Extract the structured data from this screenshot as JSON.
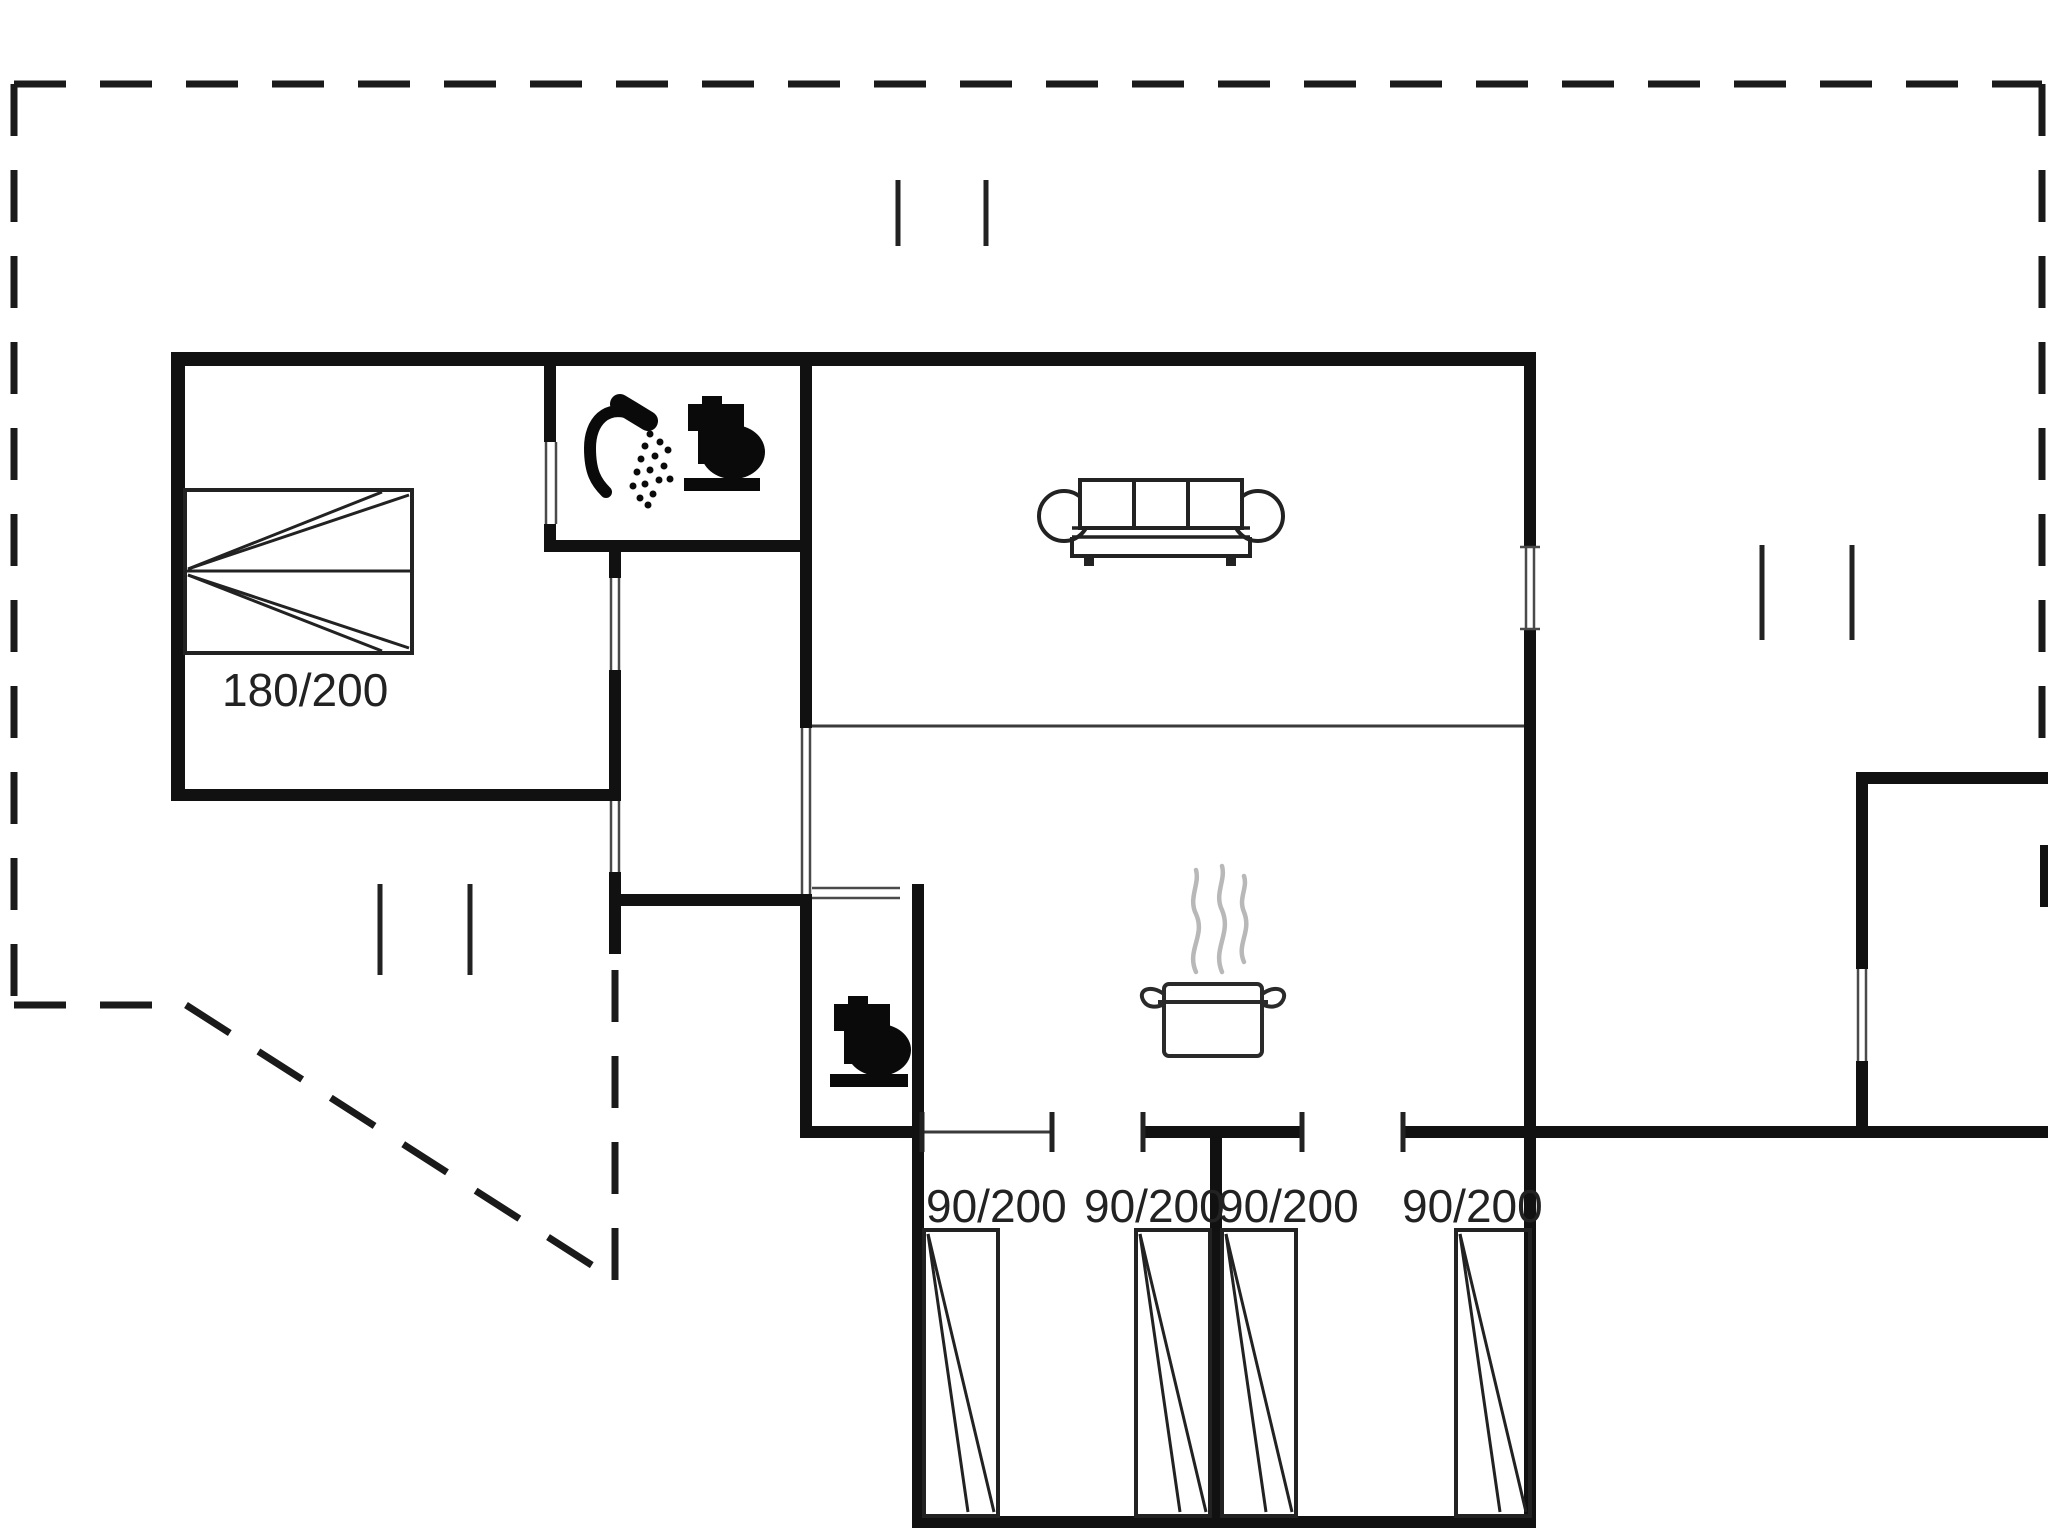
{
  "canvas": {
    "width": 2048,
    "height": 1536,
    "background": "#ffffff"
  },
  "colors": {
    "wall": "#111111",
    "thin_line": "#3a3a3a",
    "opening_line": "#4a4a4a",
    "dash": "#1a1a1a",
    "tick": "#222222",
    "furniture_stroke": "#222222",
    "icon_fill": "#0a0a0a",
    "steam": "#b8b8b8",
    "text": "#222222"
  },
  "labels": {
    "double_bed": "180/200",
    "single_bed": "90/200"
  },
  "floorplan": {
    "dashed_lines": [
      {
        "name": "boundary-top",
        "x1": 14,
        "y1": 84,
        "x2": 2042,
        "y2": 84
      },
      {
        "name": "boundary-left",
        "x1": 14,
        "y1": 84,
        "x2": 14,
        "y2": 1005
      },
      {
        "name": "boundary-bottom-left",
        "x1": 14,
        "y1": 1005,
        "x2": 186,
        "y2": 1005
      },
      {
        "name": "boundary-diagonal",
        "x1": 186,
        "y1": 1005,
        "x2": 615,
        "y2": 1280
      },
      {
        "name": "boundary-vertical-mid",
        "x1": 615,
        "y1": 1280,
        "x2": 615,
        "y2": 954
      },
      {
        "name": "boundary-right",
        "x1": 2042,
        "y1": 84,
        "x2": 2042,
        "y2": 772
      }
    ],
    "walls": [
      {
        "name": "wall-top",
        "x": 171,
        "y": 352,
        "w": 1365,
        "h": 14
      },
      {
        "name": "wall-left",
        "x": 171,
        "y": 352,
        "w": 14,
        "h": 449
      },
      {
        "name": "wall-bedroom-bottom",
        "x": 171,
        "y": 789,
        "w": 450,
        "h": 12
      },
      {
        "name": "wall-stub-under-bath",
        "x": 609,
        "y": 546,
        "w": 12,
        "h": 32
      },
      {
        "name": "wall-bedroom-hall",
        "x": 609,
        "y": 670,
        "w": 12,
        "h": 131
      },
      {
        "name": "wall-stub-below-bedroom",
        "x": 609,
        "y": 872,
        "w": 12,
        "h": 82
      },
      {
        "name": "wall-hall-bottom",
        "x": 609,
        "y": 894,
        "w": 203,
        "h": 12
      },
      {
        "name": "wall-bath-left-upper",
        "x": 544,
        "y": 366,
        "w": 12,
        "h": 76
      },
      {
        "name": "wall-bath-left-lower",
        "x": 544,
        "y": 524,
        "w": 12,
        "h": 28
      },
      {
        "name": "wall-bath-bottom",
        "x": 544,
        "y": 540,
        "w": 268,
        "h": 12
      },
      {
        "name": "wall-bath-right",
        "x": 800,
        "y": 366,
        "w": 12,
        "h": 362
      },
      {
        "name": "wall-wc-left",
        "x": 800,
        "y": 894,
        "w": 12,
        "h": 244
      },
      {
        "name": "wall-wc-bottom",
        "x": 800,
        "y": 1126,
        "w": 124,
        "h": 12
      },
      {
        "name": "wall-block-left",
        "x": 912,
        "y": 884,
        "w": 12,
        "h": 644
      },
      {
        "name": "wall-row-mid",
        "x": 1143,
        "y": 1126,
        "w": 159,
        "h": 12
      },
      {
        "name": "wall-row-right",
        "x": 1403,
        "y": 1126,
        "w": 133,
        "h": 12
      },
      {
        "name": "wall-room-divider",
        "x": 1210,
        "y": 1138,
        "w": 12,
        "h": 378
      },
      {
        "name": "wall-right-upper",
        "x": 1524,
        "y": 352,
        "w": 12,
        "h": 195
      },
      {
        "name": "wall-right-main",
        "x": 1524,
        "y": 629,
        "w": 12,
        "h": 899
      },
      {
        "name": "wall-block-bottom",
        "x": 912,
        "y": 1516,
        "w": 624,
        "h": 12
      },
      {
        "name": "wall-long-right",
        "x": 1536,
        "y": 1126,
        "w": 512,
        "h": 12
      },
      {
        "name": "wall-annex-top",
        "x": 1856,
        "y": 772,
        "w": 192,
        "h": 12
      },
      {
        "name": "wall-annex-left-upper",
        "x": 1856,
        "y": 772,
        "w": 12,
        "h": 197
      },
      {
        "name": "wall-annex-left-lower",
        "x": 1856,
        "y": 1061,
        "w": 12,
        "h": 77
      },
      {
        "name": "wall-edge-piece",
        "x": 2040,
        "y": 845,
        "w": 8,
        "h": 62
      }
    ],
    "thin_lines": [
      {
        "name": "kitchen-living-divider",
        "x1": 812,
        "y1": 726,
        "x2": 1524,
        "y2": 726
      },
      {
        "name": "window-sill-room-a",
        "x1": 924,
        "y1": 1132,
        "x2": 1052,
        "y2": 1132
      }
    ],
    "opening_lines": [
      {
        "name": "bath-door-jamb",
        "x1": 546,
        "y1": 442,
        "x2": 546,
        "y2": 524
      },
      {
        "name": "bath-door-jamb",
        "x1": 556,
        "y1": 442,
        "x2": 556,
        "y2": 524
      },
      {
        "name": "bedroom-hall-door-jamb",
        "x1": 611,
        "y1": 578,
        "x2": 611,
        "y2": 670
      },
      {
        "name": "bedroom-hall-door-jamb",
        "x1": 619,
        "y1": 578,
        "x2": 619,
        "y2": 670
      },
      {
        "name": "terrace-door-jamb",
        "x1": 611,
        "y1": 801,
        "x2": 611,
        "y2": 872
      },
      {
        "name": "terrace-door-jamb",
        "x1": 619,
        "y1": 801,
        "x2": 619,
        "y2": 872
      },
      {
        "name": "kitchen-passage-jamb",
        "x1": 802,
        "y1": 728,
        "x2": 802,
        "y2": 894
      },
      {
        "name": "kitchen-passage-jamb",
        "x1": 810,
        "y1": 728,
        "x2": 810,
        "y2": 894
      },
      {
        "name": "wc-door-jamb",
        "x1": 812,
        "y1": 888,
        "x2": 900,
        "y2": 888
      },
      {
        "name": "wc-door-jamb",
        "x1": 812,
        "y1": 898,
        "x2": 900,
        "y2": 898
      },
      {
        "name": "right-window-line",
        "x1": 1526,
        "y1": 547,
        "x2": 1526,
        "y2": 629
      },
      {
        "name": "right-window-line",
        "x1": 1534,
        "y1": 547,
        "x2": 1534,
        "y2": 629
      },
      {
        "name": "right-window-cap",
        "x1": 1520,
        "y1": 547,
        "x2": 1540,
        "y2": 547
      },
      {
        "name": "right-window-cap",
        "x1": 1520,
        "y1": 629,
        "x2": 1540,
        "y2": 629
      },
      {
        "name": "annex-door-jamb",
        "x1": 1858,
        "y1": 969,
        "x2": 1858,
        "y2": 1061
      },
      {
        "name": "annex-door-jamb",
        "x1": 1866,
        "y1": 969,
        "x2": 1866,
        "y2": 1061
      }
    ],
    "ticks": [
      {
        "name": "row-tick",
        "x1": 922,
        "y1": 1112,
        "x2": 922,
        "y2": 1152
      },
      {
        "name": "row-tick",
        "x1": 1052,
        "y1": 1112,
        "x2": 1052,
        "y2": 1152
      },
      {
        "name": "row-tick",
        "x1": 1143,
        "y1": 1112,
        "x2": 1143,
        "y2": 1152
      },
      {
        "name": "row-tick",
        "x1": 1302,
        "y1": 1112,
        "x2": 1302,
        "y2": 1152
      },
      {
        "name": "row-tick",
        "x1": 1403,
        "y1": 1112,
        "x2": 1403,
        "y2": 1152
      },
      {
        "name": "terrace-mark",
        "x1": 898,
        "y1": 180,
        "x2": 898,
        "y2": 246
      },
      {
        "name": "terrace-mark",
        "x1": 986,
        "y1": 180,
        "x2": 986,
        "y2": 246
      },
      {
        "name": "terrace-mark",
        "x1": 380,
        "y1": 884,
        "x2": 380,
        "y2": 975
      },
      {
        "name": "terrace-mark",
        "x1": 470,
        "y1": 884,
        "x2": 470,
        "y2": 975
      },
      {
        "name": "terrace-mark",
        "x1": 1762,
        "y1": 545,
        "x2": 1762,
        "y2": 640
      },
      {
        "name": "terrace-mark",
        "x1": 1852,
        "y1": 545,
        "x2": 1852,
        "y2": 640
      }
    ],
    "double_bed": {
      "name": "double-bed",
      "rect": {
        "x": 185,
        "y": 490,
        "w": 227,
        "h": 163
      },
      "mid_line": {
        "x1": 185,
        "y1": 571,
        "x2": 412,
        "y2": 571
      },
      "wedges": [
        {
          "x1": 188,
          "y1": 569,
          "x2": 409,
          "y2": 495
        },
        {
          "x1": 188,
          "y1": 569,
          "x2": 382,
          "y2": 492
        },
        {
          "x1": 188,
          "y1": 575,
          "x2": 409,
          "y2": 648
        },
        {
          "x1": 188,
          "y1": 575,
          "x2": 382,
          "y2": 651
        }
      ]
    },
    "single_beds": [
      {
        "name": "single-bed-1",
        "x": 924,
        "y": 1230,
        "w": 74,
        "h": 286
      },
      {
        "name": "single-bed-2",
        "x": 1136,
        "y": 1230,
        "w": 74,
        "h": 286
      },
      {
        "name": "single-bed-3",
        "x": 1222,
        "y": 1230,
        "w": 74,
        "h": 286
      },
      {
        "name": "single-bed-4",
        "x": 1456,
        "y": 1230,
        "w": 74,
        "h": 286
      }
    ],
    "sofa": {
      "name": "sofa",
      "cushion_rect": {
        "x": 1080,
        "y": 480,
        "w": 162,
        "h": 48
      },
      "cushion_dividers": [
        {
          "x1": 1134,
          "y1": 480,
          "x2": 1134,
          "y2": 528
        },
        {
          "x1": 1188,
          "y1": 480,
          "x2": 1188,
          "y2": 528
        }
      ],
      "seat_lines": [
        {
          "x1": 1072,
          "y1": 528,
          "x2": 1250,
          "y2": 528
        },
        {
          "x1": 1072,
          "y1": 537,
          "x2": 1250,
          "y2": 537
        }
      ],
      "base_path": "M 1072 537 L 1072 556 L 1250 556 L 1250 537",
      "feet": [
        {
          "x": 1084,
          "y": 556,
          "w": 10,
          "h": 10
        },
        {
          "x": 1226,
          "y": 556,
          "w": 10,
          "h": 10
        }
      ],
      "arms": [
        {
          "cx": 1064,
          "cy": 516,
          "r": 25
        },
        {
          "cx": 1258,
          "cy": 516,
          "r": 25
        }
      ]
    },
    "stove_pot": {
      "name": "cooking-pot",
      "body": {
        "x": 1164,
        "y": 984,
        "w": 98,
        "h": 72
      },
      "rim_line": {
        "x1": 1158,
        "y1": 1002,
        "x2": 1268,
        "y2": 1002
      },
      "handles": [
        "M 1164 994 C 1150 984 1138 990 1143 1000 C 1147 1008 1157 1008 1164 1004",
        "M 1262 994 C 1276 984 1288 990 1283 1000 C 1279 1008 1269 1008 1262 1004"
      ],
      "steam_paths": [
        "M 1196 972 C 1186 950 1206 936 1196 914 C 1188 898 1200 884 1196 870",
        "M 1222 972 C 1212 948 1232 934 1222 910 C 1214 894 1226 880 1222 866",
        "M 1244 962 C 1236 944 1252 932 1244 912 C 1238 898 1248 888 1244 876"
      ]
    },
    "toilets": [
      {
        "name": "toilet-bathroom",
        "cap": {
          "x": 702,
          "y": 396,
          "w": 20,
          "h": 9
        },
        "tank": {
          "x": 688,
          "y": 404,
          "w": 56,
          "h": 27
        },
        "neck": {
          "x": 698,
          "y": 428,
          "w": 24,
          "h": 36
        },
        "bowl": {
          "cx": 733,
          "cy": 452,
          "rx": 32,
          "ry": 27
        },
        "base": {
          "x": 684,
          "y": 478,
          "w": 76,
          "h": 13
        }
      },
      {
        "name": "toilet-wc",
        "cap": {
          "x": 848,
          "y": 996,
          "w": 20,
          "h": 9
        },
        "tank": {
          "x": 834,
          "y": 1004,
          "w": 56,
          "h": 27
        },
        "neck": {
          "x": 844,
          "y": 1028,
          "w": 24,
          "h": 36
        },
        "bowl": {
          "cx": 879,
          "cy": 1050,
          "rx": 32,
          "ry": 26
        },
        "base": {
          "x": 830,
          "y": 1074,
          "w": 78,
          "h": 13
        }
      }
    ],
    "shower": {
      "name": "shower",
      "head_line": {
        "x1": 620,
        "y1": 404,
        "x2": 648,
        "y2": 421,
        "width": 20
      },
      "arm_path": "M 632 414 C 606 404 590 422 590 448 C 590 472 596 482 606 492",
      "arm_width": 12,
      "spray_dots": [
        [
          650,
          434
        ],
        [
          660,
          442
        ],
        [
          668,
          450
        ],
        [
          645,
          446
        ],
        [
          655,
          456
        ],
        [
          664,
          466
        ],
        [
          641,
          459
        ],
        [
          650,
          470
        ],
        [
          659,
          480
        ],
        [
          637,
          472
        ],
        [
          645,
          484
        ],
        [
          653,
          494
        ],
        [
          633,
          486
        ],
        [
          640,
          498
        ],
        [
          648,
          505
        ],
        [
          670,
          479
        ]
      ]
    },
    "text_labels": [
      {
        "name": "label-double-bed",
        "text": "180/200",
        "x": 222,
        "y": 706,
        "size": 46
      },
      {
        "name": "label-single-bed-1",
        "text": "90/200",
        "x": 926,
        "y": 1222,
        "size": 46
      },
      {
        "name": "label-single-bed-2",
        "text": "90/200",
        "x": 1084,
        "y": 1222,
        "size": 46
      },
      {
        "name": "label-single-bed-3",
        "text": "1218",
        "x": 1218,
        "y": 1222,
        "size": 46
      },
      {
        "name": "label-single-bed-4",
        "text": "90/200",
        "x": 1402,
        "y": 1222,
        "size": 46
      }
    ]
  }
}
